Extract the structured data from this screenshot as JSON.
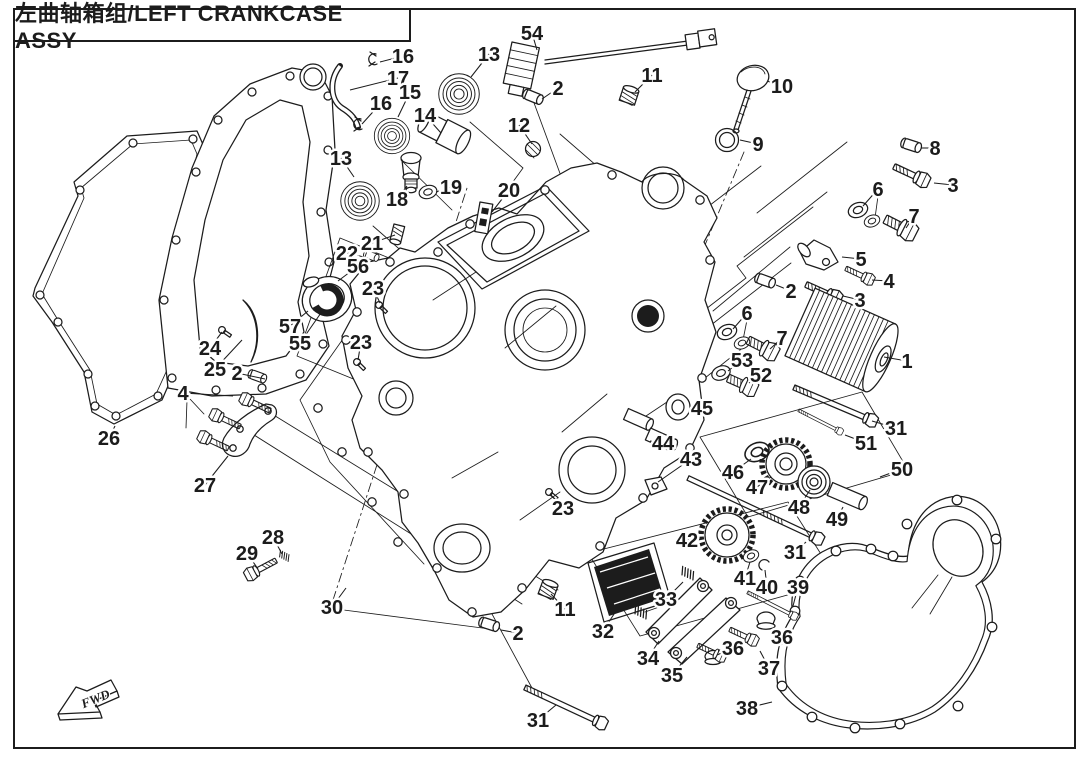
{
  "title": "左曲轴箱组/LEFT CRANKCASE ASSY",
  "fwd_marker": "FWD",
  "colors": {
    "ink": "#1c1c1c",
    "paper": "#ffffff"
  },
  "callouts": [
    {
      "n": "16",
      "x": 403,
      "y": 56,
      "tx": 380,
      "ty": 62
    },
    {
      "n": "17",
      "x": 398,
      "y": 78,
      "tx": 350,
      "ty": 90
    },
    {
      "n": "16",
      "x": 381,
      "y": 103,
      "tx": 362,
      "ty": 124
    },
    {
      "n": "15",
      "x": 410,
      "y": 92,
      "tx": 398,
      "ty": 117
    },
    {
      "n": "13",
      "x": 489,
      "y": 54,
      "tx": 471,
      "ty": 77
    },
    {
      "n": "54",
      "x": 532,
      "y": 33,
      "tx": 537,
      "ty": 50
    },
    {
      "n": "2",
      "x": 558,
      "y": 88,
      "tx": 542,
      "ty": 99
    },
    {
      "n": "14",
      "x": 425,
      "y": 115,
      "tx": 441,
      "ty": 133
    },
    {
      "n": "12",
      "x": 519,
      "y": 125,
      "tx": 532,
      "ty": 144
    },
    {
      "n": "11",
      "x": 652,
      "y": 75,
      "tx": 635,
      "ty": 92
    },
    {
      "n": "10",
      "x": 782,
      "y": 86,
      "tx": 767,
      "ty": 81
    },
    {
      "n": "9",
      "x": 758,
      "y": 144,
      "tx": 740,
      "ty": 140
    },
    {
      "n": "13",
      "x": 341,
      "y": 158,
      "tx": 354,
      "ty": 177
    },
    {
      "n": "18",
      "x": 397,
      "y": 199,
      "tx": 407,
      "ty": 186
    },
    {
      "n": "19",
      "x": 451,
      "y": 187,
      "tx": 436,
      "ty": 192
    },
    {
      "n": "20",
      "x": 509,
      "y": 190,
      "tx": 492,
      "ty": 212
    },
    {
      "n": "8",
      "x": 935,
      "y": 148,
      "tx": 921,
      "ty": 148
    },
    {
      "n": "3",
      "x": 953,
      "y": 185,
      "tx": 934,
      "ty": 183
    },
    {
      "n": "6",
      "x": 878,
      "y": 189,
      "tx": 863,
      "ty": 206
    },
    {
      "n": "7",
      "x": 914,
      "y": 216,
      "tx": 906,
      "ty": 228
    },
    {
      "n": "5",
      "x": 861,
      "y": 259,
      "tx": 842,
      "ty": 257
    },
    {
      "n": "4",
      "x": 889,
      "y": 281,
      "tx": 872,
      "ty": 280
    },
    {
      "n": "2",
      "x": 791,
      "y": 291,
      "tx": 776,
      "ty": 285
    },
    {
      "n": "3",
      "x": 860,
      "y": 300,
      "tx": 843,
      "ty": 296
    },
    {
      "n": "6",
      "x": 747,
      "y": 313,
      "tx": 733,
      "ty": 329
    },
    {
      "n": "7",
      "x": 782,
      "y": 338,
      "tx": 770,
      "ty": 349
    },
    {
      "n": "53",
      "x": 742,
      "y": 360,
      "tx": 728,
      "ty": 371
    },
    {
      "n": "52",
      "x": 761,
      "y": 375,
      "tx": 749,
      "ty": 383
    },
    {
      "n": "1",
      "x": 907,
      "y": 361,
      "tx": 884,
      "ty": 357
    },
    {
      "n": "45",
      "x": 702,
      "y": 408,
      "tx": 690,
      "ty": 407
    },
    {
      "n": "44",
      "x": 663,
      "y": 443,
      "tx": 650,
      "ty": 441
    },
    {
      "n": "43",
      "x": 691,
      "y": 459,
      "tx": 658,
      "ty": 482
    },
    {
      "n": "46",
      "x": 733,
      "y": 472,
      "tx": 751,
      "ty": 459
    },
    {
      "n": "47",
      "x": 757,
      "y": 487,
      "tx": 771,
      "ty": 477
    },
    {
      "n": "48",
      "x": 799,
      "y": 507,
      "tx": 810,
      "ty": 490
    },
    {
      "n": "49",
      "x": 837,
      "y": 519,
      "tx": 843,
      "ty": 507
    },
    {
      "n": "50",
      "x": 902,
      "y": 469,
      "tx": 880,
      "ty": 477
    },
    {
      "n": "31",
      "x": 896,
      "y": 428,
      "tx": 872,
      "ty": 421
    },
    {
      "n": "51",
      "x": 866,
      "y": 443,
      "tx": 845,
      "ty": 435
    },
    {
      "n": "31",
      "x": 795,
      "y": 552,
      "tx": 806,
      "ty": 542
    },
    {
      "n": "21",
      "x": 372,
      "y": 243,
      "tx": 395,
      "ty": 235
    },
    {
      "n": "22",
      "x": 347,
      "y": 253,
      "tx": 368,
      "ty": 258
    },
    {
      "n": "56",
      "x": 358,
      "y": 266,
      "tx": 338,
      "ty": 281
    },
    {
      "n": "23",
      "x": 373,
      "y": 288,
      "tx": 380,
      "ty": 303
    },
    {
      "n": "57",
      "x": 290,
      "y": 326,
      "tx": 308,
      "ty": 311
    },
    {
      "n": "55",
      "x": 300,
      "y": 343,
      "tx": 323,
      "ty": 310
    },
    {
      "n": "23",
      "x": 361,
      "y": 342,
      "tx": 358,
      "ty": 360
    },
    {
      "n": "24",
      "x": 210,
      "y": 348,
      "tx": 222,
      "ty": 332
    },
    {
      "n": "25",
      "x": 215,
      "y": 369,
      "tx": 242,
      "ty": 340
    },
    {
      "n": "2",
      "x": 237,
      "y": 373,
      "tx": 265,
      "ty": 379
    },
    {
      "n": "26",
      "x": 109,
      "y": 438,
      "tx": 115,
      "ty": 426
    },
    {
      "n": "4",
      "x": 183,
      "y": 393,
      "tx": 233,
      "ty": 396
    },
    {
      "n": "27",
      "x": 205,
      "y": 485,
      "tx": 228,
      "ty": 456
    },
    {
      "n": "28",
      "x": 273,
      "y": 537,
      "tx": 282,
      "ty": 554
    },
    {
      "n": "29",
      "x": 247,
      "y": 553,
      "tx": 258,
      "ty": 569
    },
    {
      "n": "30",
      "x": 332,
      "y": 607,
      "tx": 346,
      "ty": 588
    },
    {
      "n": "23",
      "x": 563,
      "y": 508,
      "tx": 551,
      "ty": 495
    },
    {
      "n": "11",
      "x": 565,
      "y": 609,
      "tx": 551,
      "ty": 594
    },
    {
      "n": "2",
      "x": 518,
      "y": 633,
      "tx": 501,
      "ty": 630
    },
    {
      "n": "32",
      "x": 603,
      "y": 631,
      "tx": 616,
      "ty": 611
    },
    {
      "n": "33",
      "x": 666,
      "y": 599,
      "tx": 683,
      "ty": 582
    },
    {
      "n": "34",
      "x": 648,
      "y": 658,
      "tx": 659,
      "ty": 641
    },
    {
      "n": "35",
      "x": 672,
      "y": 675,
      "tx": 687,
      "ty": 657
    },
    {
      "n": "36",
      "x": 733,
      "y": 648,
      "tx": 717,
      "ty": 655
    },
    {
      "n": "36",
      "x": 782,
      "y": 637,
      "tx": 770,
      "ty": 634
    },
    {
      "n": "37",
      "x": 769,
      "y": 668,
      "tx": 760,
      "ty": 651
    },
    {
      "n": "39",
      "x": 798,
      "y": 587,
      "tx": 793,
      "ty": 606
    },
    {
      "n": "40",
      "x": 767,
      "y": 587,
      "tx": 765,
      "ty": 570
    },
    {
      "n": "41",
      "x": 745,
      "y": 578,
      "tx": 750,
      "ty": 562
    },
    {
      "n": "42",
      "x": 687,
      "y": 540,
      "tx": 702,
      "ty": 538
    },
    {
      "n": "31",
      "x": 538,
      "y": 720,
      "tx": 556,
      "ty": 705
    },
    {
      "n": "38",
      "x": 747,
      "y": 708,
      "tx": 772,
      "ty": 702
    }
  ]
}
